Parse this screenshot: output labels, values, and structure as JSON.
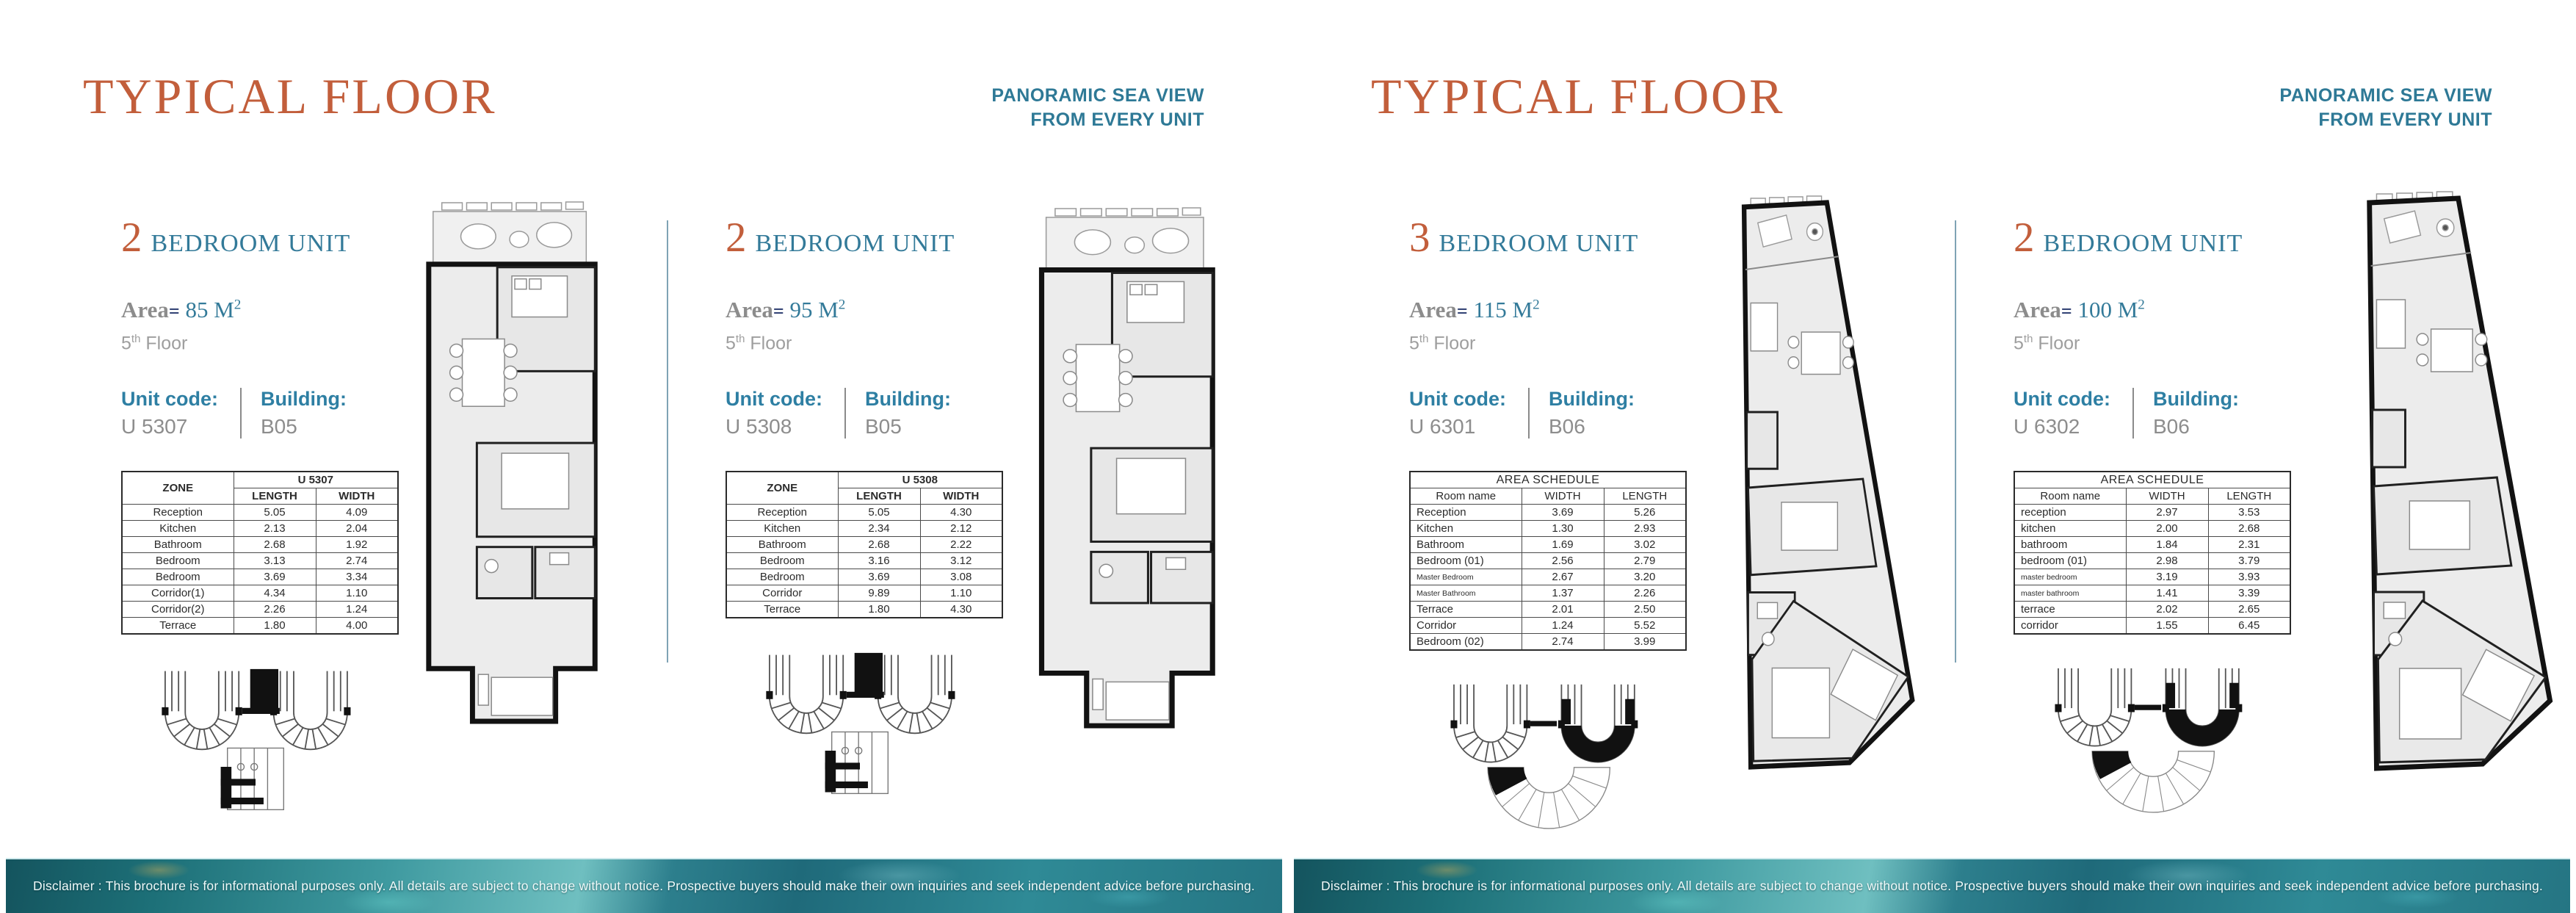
{
  "colors": {
    "title_orange": "#C25E3B",
    "heading_teal": "#337A99",
    "sea_view_teal": "#2E7996",
    "label_teal": "#2E7FA3",
    "value_gray": "#8D8D8D",
    "floor_gray": "#9E9E9E",
    "equals_navy": "#24356B",
    "column_divider_blue": "#7FA3B5",
    "strip_teal": "#2F8A96"
  },
  "pages": [
    {
      "title": "TYPICAL FLOOR",
      "sea_view": {
        "line1": "PANORAMIC SEA VIEW",
        "line2": "FROM EVERY UNIT"
      },
      "disclaimer": "Disclaimer : This brochure is for informational purposes only. All details are subject to change without notice. Prospective buyers should make their own inquiries and seek independent advice before purchasing.",
      "units": [
        {
          "bedrooms": "2",
          "type_label": "BEDROOM UNIT",
          "area_label": "Area",
          "area_equals": "=",
          "area_value": "85 M",
          "area_sup": "2",
          "floor_number": "5",
          "floor_sup": "th",
          "floor_label": "Floor",
          "unit_code_label": "Unit code:",
          "unit_code": "U 5307",
          "building_label": "Building:",
          "building": "B05",
          "table": {
            "corner": "ZONE",
            "span_header": "U 5307",
            "col1": "LENGTH",
            "col2": "WIDTH",
            "rows": [
              [
                "Reception",
                "5.05",
                "4.09"
              ],
              [
                "Kitchen",
                "2.13",
                "2.04"
              ],
              [
                "Bathroom",
                "2.68",
                "1.92"
              ],
              [
                "Bedroom",
                "3.13",
                "2.74"
              ],
              [
                "Bedroom",
                "3.69",
                "3.34"
              ],
              [
                "Corridor(1)",
                "4.34",
                "1.10"
              ],
              [
                "Corridor(2)",
                "2.26",
                "1.24"
              ],
              [
                "Terrace",
                "1.80",
                "4.00"
              ]
            ]
          }
        },
        {
          "bedrooms": "2",
          "type_label": "BEDROOM UNIT",
          "area_label": "Area",
          "area_equals": "=",
          "area_value": "95 M",
          "area_sup": "2",
          "floor_number": "5",
          "floor_sup": "th",
          "floor_label": "Floor",
          "unit_code_label": "Unit code:",
          "unit_code": "U 5308",
          "building_label": "Building:",
          "building": "B05",
          "table": {
            "corner": "ZONE",
            "span_header": "U 5308",
            "col1": "LENGTH",
            "col2": "WIDTH",
            "rows": [
              [
                "Reception",
                "5.05",
                "4.30"
              ],
              [
                "Kitchen",
                "2.34",
                "2.12"
              ],
              [
                "Bathroom",
                "2.68",
                "2.22"
              ],
              [
                "Bedroom",
                "3.16",
                "3.12"
              ],
              [
                "Bedroom",
                "3.69",
                "3.08"
              ],
              [
                "Corridor",
                "9.89",
                "1.10"
              ],
              [
                "Terrace",
                "1.80",
                "4.30"
              ]
            ]
          }
        }
      ]
    },
    {
      "title": "TYPICAL FLOOR",
      "sea_view": {
        "line1": "PANORAMIC SEA VIEW",
        "line2": "FROM EVERY UNIT"
      },
      "disclaimer": "Disclaimer : This brochure is for informational purposes only. All details are subject to change without notice. Prospective buyers should make their own inquiries and seek independent advice before purchasing.",
      "units": [
        {
          "bedrooms": "3",
          "type_label": "BEDROOM UNIT",
          "area_label": "Area",
          "area_equals": "=",
          "area_value": "115 M",
          "area_sup": "2",
          "floor_number": "5",
          "floor_sup": "th",
          "floor_label": "Floor",
          "unit_code_label": "Unit code:",
          "unit_code": "U 6301",
          "building_label": "Building:",
          "building": "B06",
          "table": {
            "title": "AREA SCHEDULE",
            "corner": "Room name",
            "col1": "WIDTH",
            "col2": "LENGTH",
            "rows": [
              [
                "Reception",
                "3.69",
                "5.26"
              ],
              [
                "Kitchen",
                "1.30",
                "2.93"
              ],
              [
                "Bathroom",
                "1.69",
                "3.02"
              ],
              [
                "Bedroom (01)",
                "2.56",
                "2.79"
              ],
              [
                "Master Bedroom",
                "2.67",
                "3.20"
              ],
              [
                "Master Bathroom",
                "1.37",
                "2.26"
              ],
              [
                "Terrace",
                "2.01",
                "2.50"
              ],
              [
                "Corridor",
                "1.24",
                "5.52"
              ],
              [
                "Bedroom (02)",
                "2.74",
                "3.99"
              ]
            ]
          }
        },
        {
          "bedrooms": "2",
          "type_label": "BEDROOM UNIT",
          "area_label": "Area",
          "area_equals": "=",
          "area_value": "100 M",
          "area_sup": "2",
          "floor_number": "5",
          "floor_sup": "th",
          "floor_label": "Floor",
          "unit_code_label": "Unit code:",
          "unit_code": "U 6302",
          "building_label": "Building:",
          "building": "B06",
          "table": {
            "title": "AREA SCHEDULE",
            "corner": "Room name",
            "col1": "WIDTH",
            "col2": "LENGTH",
            "rows": [
              [
                "reception",
                "2.97",
                "3.53"
              ],
              [
                "kitchen",
                "2.00",
                "2.68"
              ],
              [
                "bathroom",
                "1.84",
                "2.31"
              ],
              [
                "bedroom (01)",
                "2.98",
                "3.79"
              ],
              [
                "master bedroom",
                "3.19",
                "3.93"
              ],
              [
                "master bathroom",
                "1.41",
                "3.39"
              ],
              [
                "terrace",
                "2.02",
                "2.65"
              ],
              [
                "corridor",
                "1.55",
                "6.45"
              ]
            ]
          }
        }
      ]
    }
  ]
}
